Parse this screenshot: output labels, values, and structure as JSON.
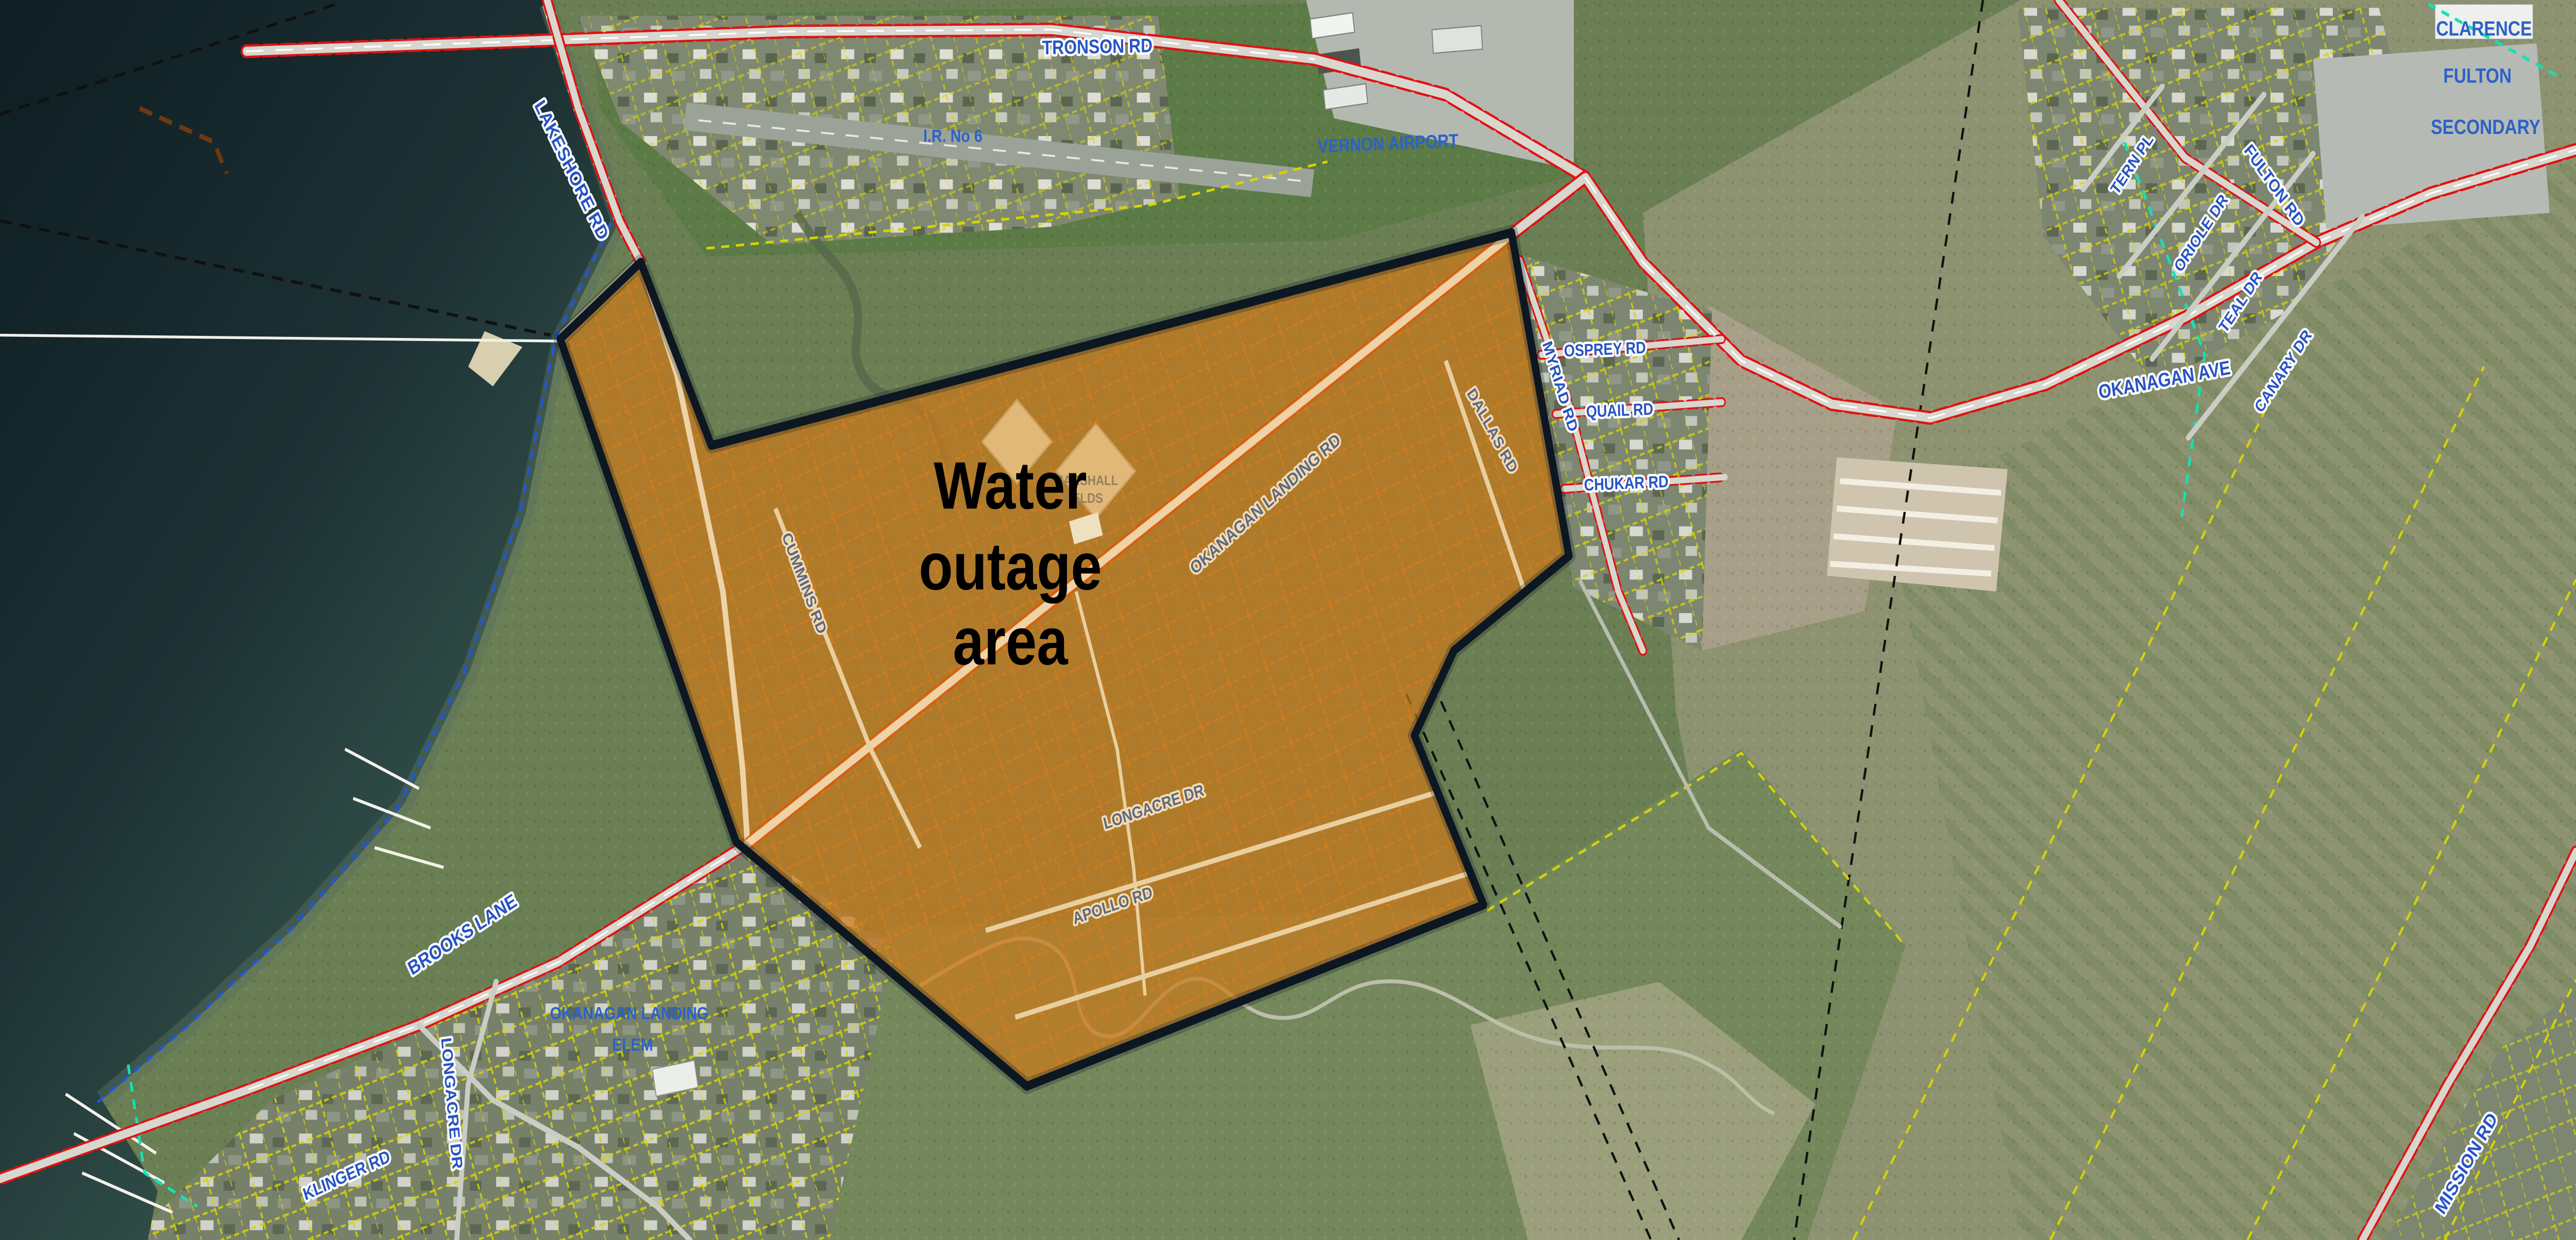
{
  "annotation": {
    "line1": "Water",
    "line2": "outage",
    "line3": "area"
  },
  "labels": {
    "tronson_rd": "TRONSON RD",
    "lakeshore_rd": "LAKESHORE RD",
    "ir_no_6": "I.R. No 6",
    "vernon_airport": "VERNON AIRPORT",
    "clarence_line1": "CLARENCE",
    "clarence_line2": "FULTON",
    "clarence_line3": "SECONDARY",
    "tern_pl": "TERN PL",
    "oriole_dr": "ORIOLE DR",
    "teal_dr": "TEAL DR",
    "canary_dr": "CANARY DR",
    "fulton_rd": "FULTON RD",
    "osprey_rd": "OSPREY RD",
    "quail_rd": "QUAIL RD",
    "chukar_rd": "CHUKAR RD",
    "myriad_rd": "MYRIAD RD",
    "okanagan_ave": "OKANAGAN AVE",
    "okanagan_landing_rd": "OKANAGAN LANDING RD",
    "dallas_rd": "DALLAS RD",
    "cummins_rd": "CUMMINS RD",
    "marshall_line1": "MARSHALL",
    "marshall_line2": "FIELDS",
    "longacre_dr": "LONGACRE DR",
    "apollo_rd": "APOLLO RD",
    "brooks_lane": "BROOKS LANE",
    "okanagan_landing_elem_line1": "OKANAGAN LANDING",
    "okanagan_landing_elem_line2": "ELEM",
    "klinger_rd": "KLINGER RD",
    "longacre_dr_south": "LONGACRE DR",
    "mission_rd": "MISSION RD"
  },
  "colors": {
    "outage_fill": "#c97a1c",
    "outage_border": "#0c1722",
    "road_label_blue": "#2753c4",
    "parcel_yellow": "#d6d400",
    "road_edge_red": "#e11111",
    "water_deep": "#0f1f24",
    "water_shallow": "#35544c"
  }
}
